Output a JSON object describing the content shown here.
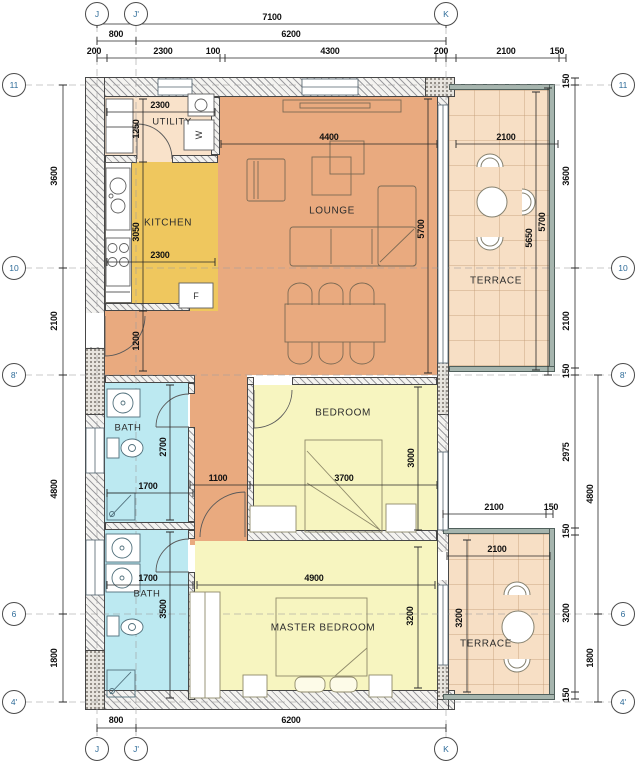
{
  "drawing": {
    "type": "apartment floor plan"
  },
  "colors": {
    "lounge": "#e9aa7f",
    "kitchen": "#efc75e",
    "utility": "#f9e2ca",
    "bedroom": "#f7f5c0",
    "bath": "#bce9f1",
    "terrace": "#f7dfc5",
    "wall_edge": "#474747",
    "grid_text": "#2f6c99",
    "dim_text": "#111111"
  },
  "grid": {
    "top": [
      "J",
      "J'",
      "K"
    ],
    "bottom": [
      "J",
      "J'",
      "K"
    ],
    "left": [
      "11",
      "10",
      "8'",
      "6",
      "4'"
    ],
    "right": [
      "11",
      "10",
      "8'",
      "6",
      "4'"
    ]
  },
  "rooms": {
    "utility": {
      "label": "UTILITY"
    },
    "kitchen": {
      "label": "KITCHEN"
    },
    "lounge": {
      "label": "LOUNGE"
    },
    "bedroom": {
      "label": "BEDROOM"
    },
    "master_bedroom": {
      "label": "MASTER BEDROOM"
    },
    "bath_top": {
      "label": "BATH"
    },
    "bath_bottom": {
      "label": "BATH"
    },
    "terrace_top": {
      "label": "TERRACE"
    },
    "terrace_bottom": {
      "label": "TERRACE"
    }
  },
  "appliances": {
    "washer": "W",
    "fridge": "F"
  },
  "dims": {
    "overall_w": "7100",
    "j_jp": "800",
    "jp_k": "6200",
    "t200a": "200",
    "t2300": "2300",
    "t100": "100",
    "t4300": "4300",
    "t200b": "200",
    "t2100": "2100",
    "t150": "150",
    "b800": "800",
    "b6200": "6200",
    "l3600": "3600",
    "l2100": "2100",
    "l4800": "4800",
    "l1800": "1800",
    "r150a": "150",
    "r3600": "3600",
    "r2100": "2100",
    "r150b": "150",
    "r2975": "2975",
    "r4800": "4800",
    "r150c": "150",
    "r3200": "3200",
    "r1800": "1800",
    "r150d": "150",
    "utility_w": "2300",
    "utility_d": "1250",
    "kitchen_d": "3050",
    "kitchen_w": "2300",
    "corridor": "1200",
    "lounge_w": "4400",
    "lounge_d": "5700",
    "terr1_w": "2100",
    "terr1_d": "5650",
    "terr1_g": "5700",
    "hall": "1100",
    "bed_w": "3700",
    "bed_d": "3000",
    "bath1_w": "1700",
    "bath1_d": "2700",
    "bath2_w": "1700",
    "bath2_d": "3500",
    "master_w": "4900",
    "master_d": "3200",
    "terr2_wo": "2100",
    "terr2_off": "150",
    "terr2_w": "2100",
    "terr2_d": "3200"
  }
}
